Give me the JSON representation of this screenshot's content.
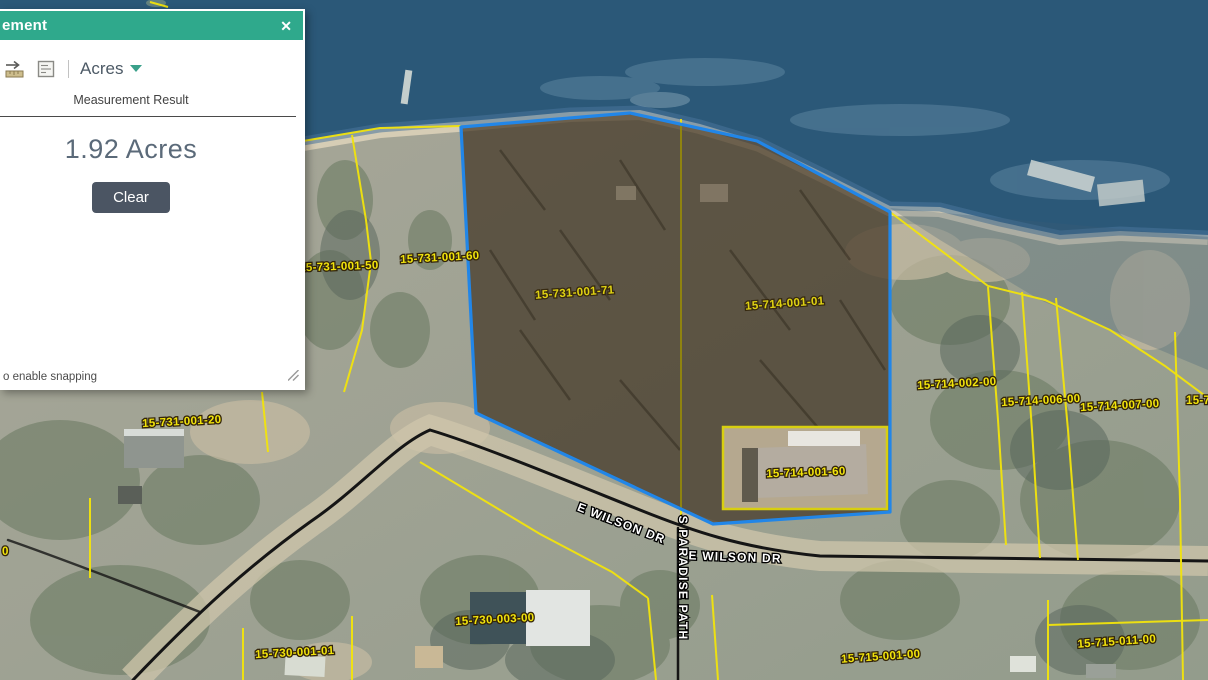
{
  "panel": {
    "title_visible": "ement",
    "close": "✕",
    "toolbar": {
      "icons": [
        "distance-measure-icon",
        "location-measure-icon"
      ],
      "unit": "Acres"
    },
    "result_heading": "Measurement Result",
    "result_value": "1.92 Acres",
    "clear": "Clear",
    "snapping_hint": "o enable snapping"
  },
  "map": {
    "road_labels": [
      {
        "text": "E WILSON DR"
      },
      {
        "text": "E WILSON DR"
      },
      {
        "text": "S PARADISE PATH"
      }
    ],
    "parcel_labels": [
      {
        "text": "15-731-001-50"
      },
      {
        "text": "15-731-001-60"
      },
      {
        "text": "15-731-001-71"
      },
      {
        "text": "15-714-001-01"
      },
      {
        "text": "15-714-002-00"
      },
      {
        "text": "15-714-006-00"
      },
      {
        "text": "15-714-007-00"
      },
      {
        "text": "15-7"
      },
      {
        "text": "15-714-001-60"
      },
      {
        "text": "15-731-001-20"
      },
      {
        "text": "15-730-003-00"
      },
      {
        "text": "15-730-001-01"
      },
      {
        "text": "15-715-001-00"
      },
      {
        "text": "15-715-011-00"
      },
      {
        "text": "0"
      }
    ]
  },
  "colors": {
    "header_teal": "#2fa98c",
    "highlight_blue": "#2186e8",
    "parcel_yellow": "#f2e40c",
    "water_blue": "#2b5878",
    "clear_button": "#4b5563"
  }
}
